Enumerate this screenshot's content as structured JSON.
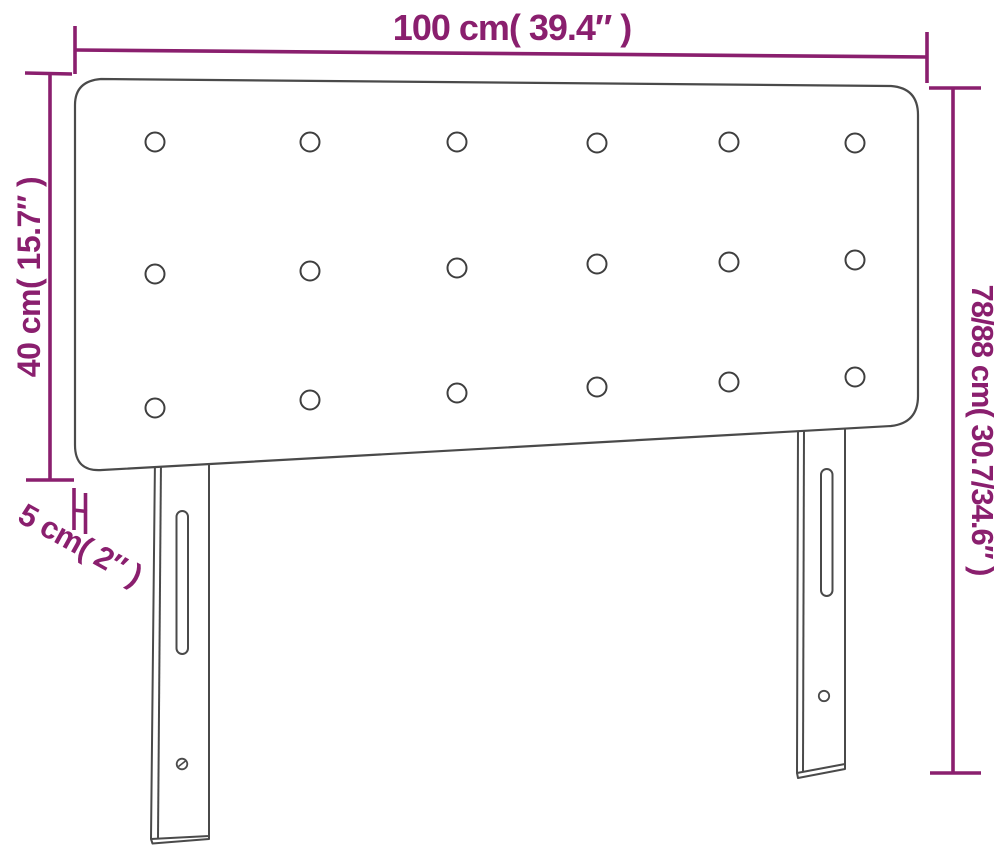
{
  "diagram": {
    "kind": "product-dimension-diagram",
    "product": "upholstered-headboard-with-two-legs",
    "labels": {
      "width": "100 cm( 39.4″ )",
      "height_left": "40 cm( 15.7″ )",
      "height_right": "78/88 cm( 30.7/34.6″ )",
      "depth": "5 cm( 2″ )"
    },
    "tufting": {
      "button_rows": 3,
      "button_columns": 6,
      "button_count": 18
    },
    "legs": {
      "count": 2,
      "slot_count": 2,
      "screw_hole_count": 2
    },
    "colors": {
      "dimension_accent": "#8a1f6e",
      "outline_gray": "#4a4a4a",
      "background": "#ffffff"
    }
  }
}
